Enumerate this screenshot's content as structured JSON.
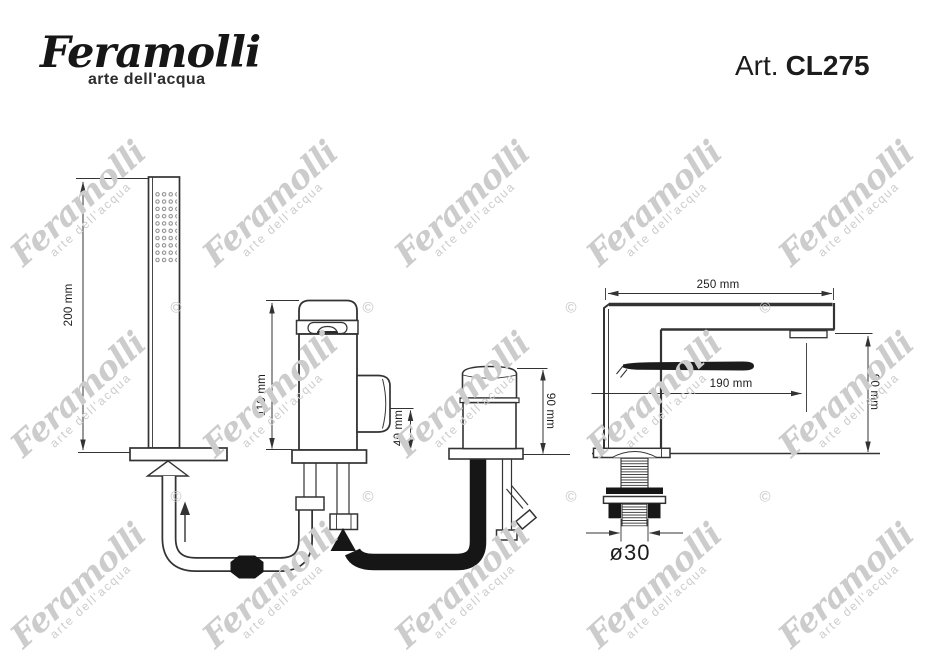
{
  "header": {
    "brand": "Feramolli",
    "tagline": "arte dell'acqua",
    "article_prefix": "Art.",
    "article_code": "CL275"
  },
  "dimensions": {
    "handshower_height": "200 mm",
    "mixer_height": "110 mm",
    "mixer_knob": "40 mm",
    "diverter_height": "90 mm",
    "spout_reach": "250 mm",
    "spout_outlet_reach": "190 mm",
    "spout_height": "90 mm",
    "shank_diameter": "ø30"
  },
  "watermark": {
    "text": "Feramolli",
    "tagline": "arte dell'acqua",
    "symbol": "©",
    "color": "#cccccc",
    "symbol_color": "#c6c6c6",
    "angle_deg": -42,
    "tile_centers_x": [
      82,
      274,
      466,
      658,
      850
    ],
    "tile_centers_y": [
      208,
      399,
      590
    ],
    "symbol_points": [
      [
        176,
        308
      ],
      [
        368,
        308
      ],
      [
        571,
        308
      ],
      [
        765,
        308
      ],
      [
        176,
        497
      ],
      [
        368,
        497
      ],
      [
        571,
        497
      ],
      [
        765,
        497
      ]
    ]
  },
  "drawing": {
    "line_color": "#333333",
    "black_fill": "#161616"
  }
}
